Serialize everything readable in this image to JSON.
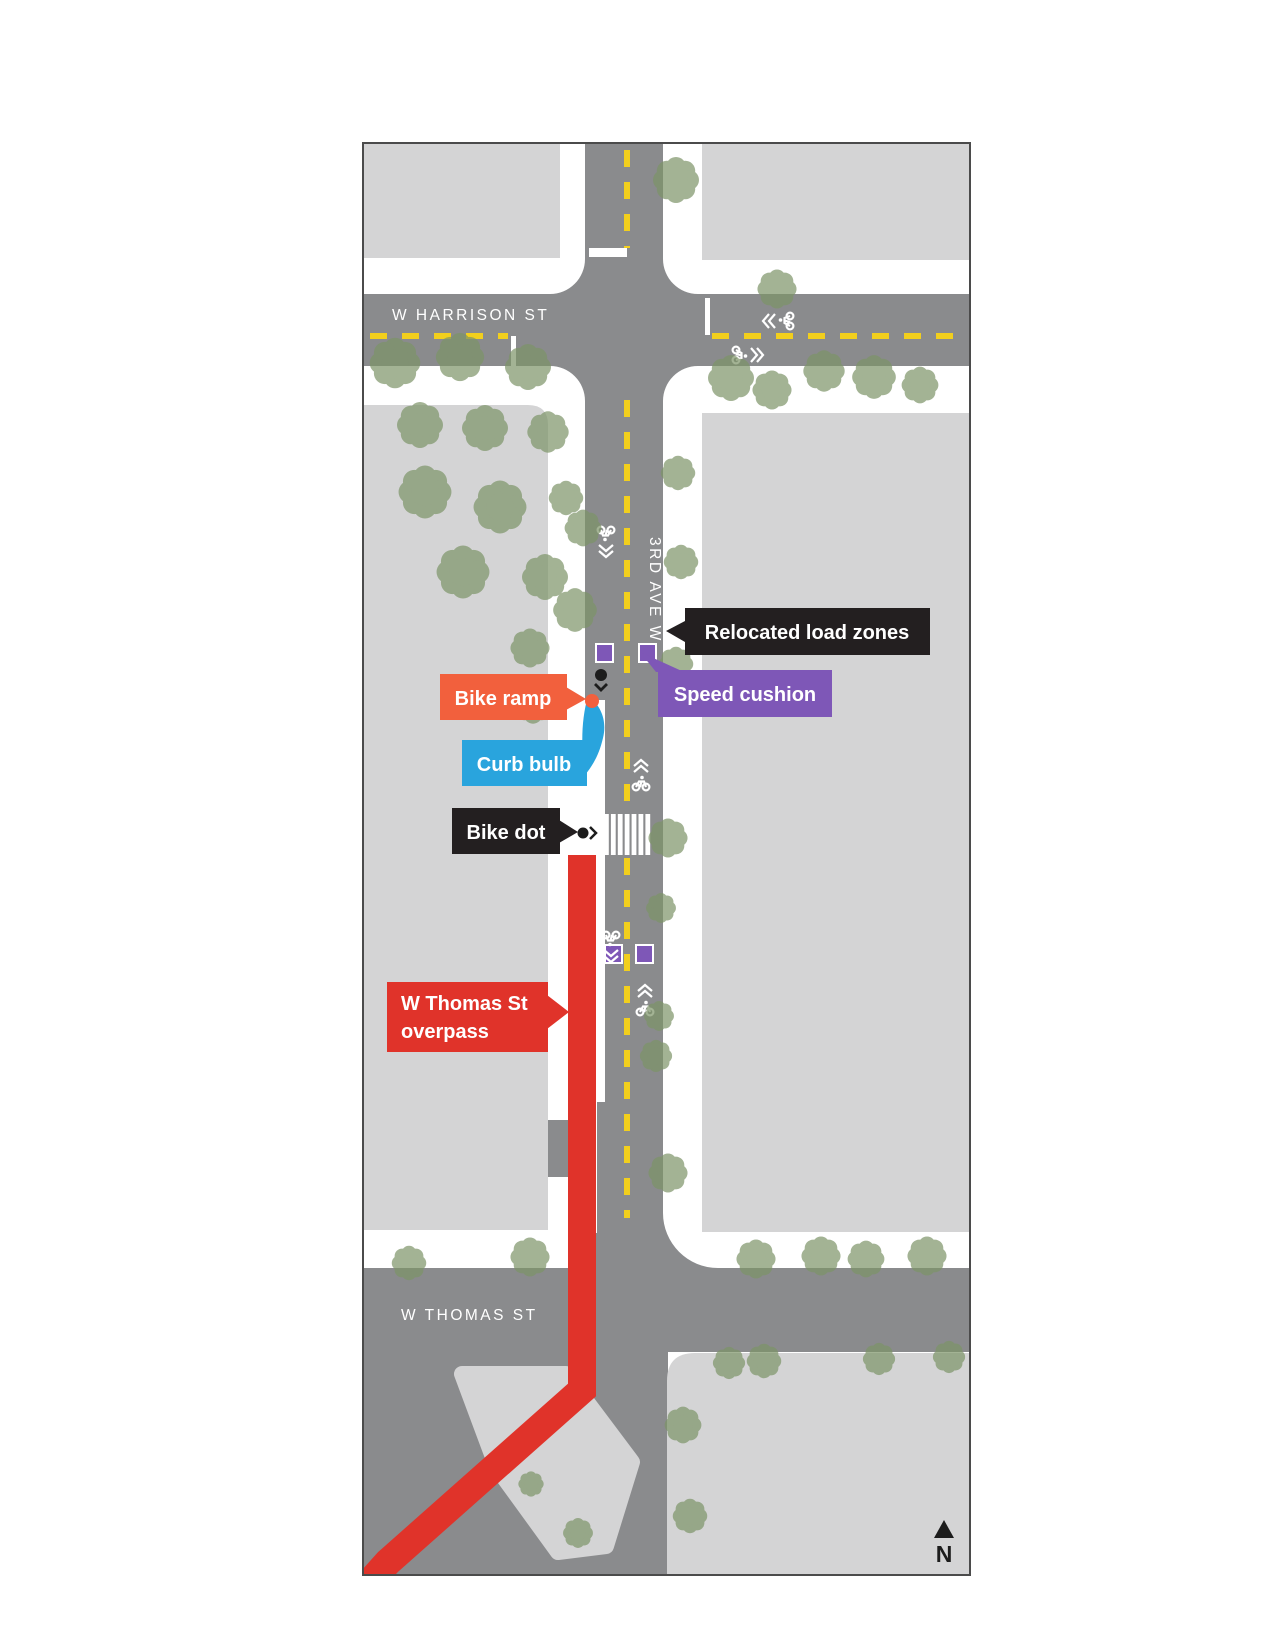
{
  "map": {
    "streets": {
      "harrison": "W HARRISON ST",
      "third_ave": "3RD AVE W",
      "thomas": "W THOMAS ST"
    },
    "callouts": {
      "relocated_load_zones": "Relocated load zones",
      "speed_cushion": "Speed cushion",
      "bike_ramp": "Bike ramp",
      "curb_bulb": "Curb bulb",
      "bike_dot": "Bike dot",
      "overpass_line1": "W Thomas St",
      "overpass_line2": "overpass"
    },
    "compass": {
      "north_label": "N"
    },
    "icons": {
      "sharrow": "bike-sharrow-icon",
      "north": "north-arrow-icon",
      "tree": "tree-icon",
      "bike_dot": "bike-dot-icon",
      "speed_cushion_marker": "speed-cushion-marker-icon"
    },
    "colors": {
      "road": "#8a8b8d",
      "block": "#d4d4d5",
      "sidewalk": "#ffffff",
      "tree": "#7d9468",
      "centerline": "#f2cf1d",
      "overpass_red": "#e0332a",
      "bike_ramp_orange": "#f2603d",
      "curb_bulb_blue": "#29a4dd",
      "speed_cushion_purple": "#7e57b7",
      "label_black": "#231f20"
    }
  }
}
